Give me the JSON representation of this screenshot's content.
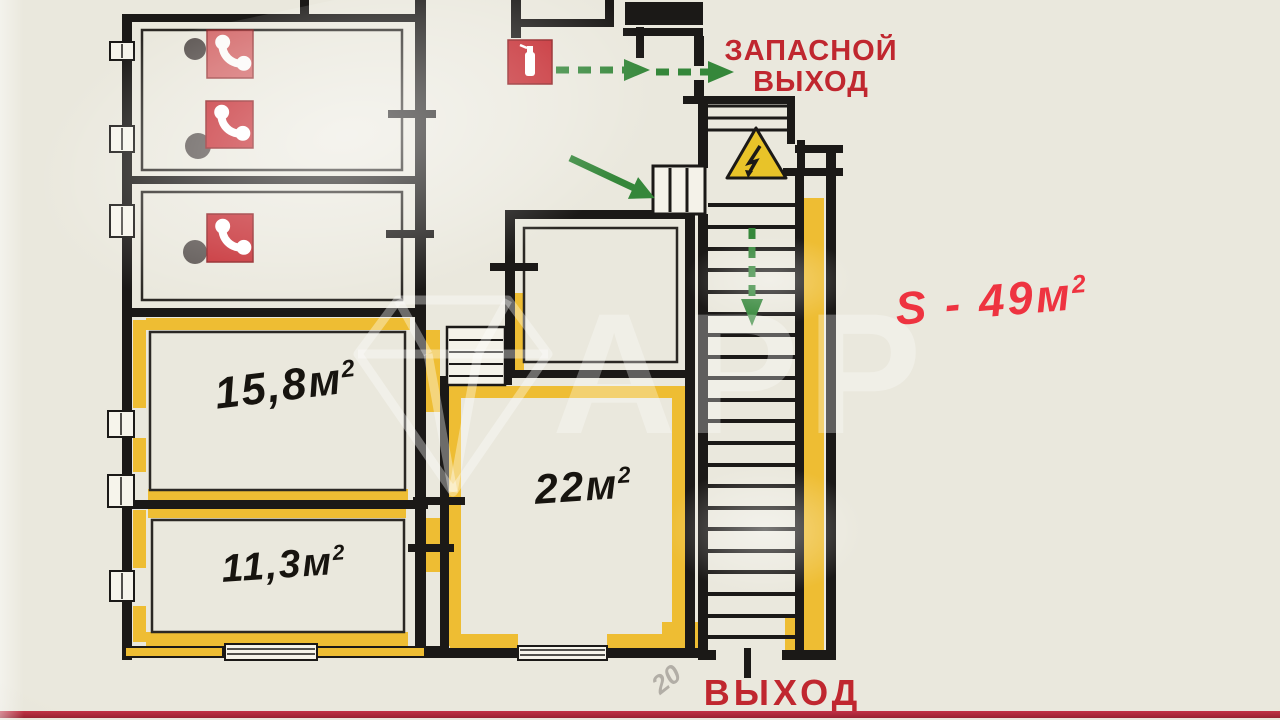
{
  "labels": {
    "emergency_exit_line1": "ЗАПАСНОЙ",
    "emergency_exit_line2": "ВЫХОД",
    "exit": "ВЫХОД",
    "total_area": {
      "text": "S - 49м",
      "sup": "2"
    },
    "faint_mark": "20"
  },
  "rooms": [
    {
      "id": "room-15-8",
      "area": "15,8м",
      "sup": "2"
    },
    {
      "id": "room-11-3",
      "area": "11,3м",
      "sup": "2"
    },
    {
      "id": "room-22",
      "area": "22м",
      "sup": "2"
    }
  ],
  "watermark": {
    "text": "APP"
  },
  "icons": [
    {
      "name": "fire-phone-icon",
      "count": 3
    },
    {
      "name": "fire-extinguisher-icon",
      "count": 1
    },
    {
      "name": "electrical-hazard-icon",
      "count": 1
    }
  ],
  "colors": {
    "background": "#eae8dd",
    "wall": "#1b1917",
    "premises_highlight": "#eebd33",
    "sign_red": "#c4262c",
    "label_red": "#c0272f",
    "handwriting_red": "#ee3340",
    "evacuation_green": "#35873a"
  }
}
